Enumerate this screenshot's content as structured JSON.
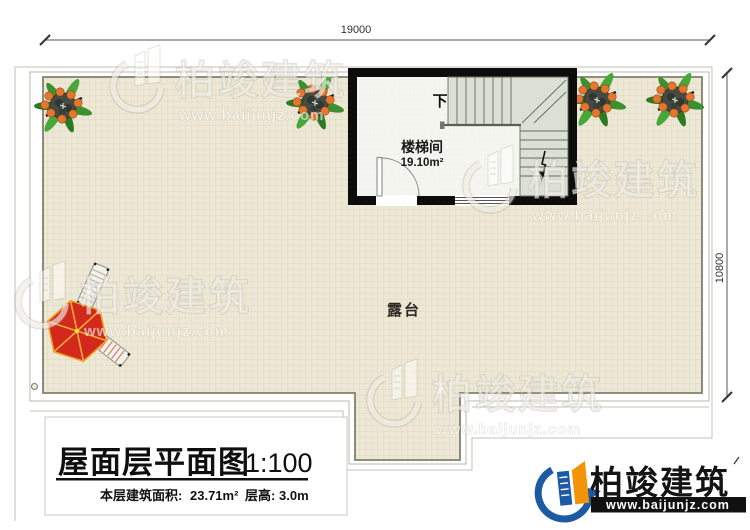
{
  "dimensions": {
    "top": "19000",
    "right": "10800"
  },
  "stairwell": {
    "name": "楼梯间",
    "area": "19.10m²",
    "direction": "下"
  },
  "terrace": {
    "label": "露台"
  },
  "title_block": {
    "title": "屋面层平面图",
    "scale": "1:100",
    "area_label": "本层建筑面积:",
    "area_value": "23.71m²",
    "floor_height_label": "层高:",
    "floor_height_value": "3.0m"
  },
  "logo": {
    "brand": "柏竣建筑",
    "website": "www.baijunjz.com"
  },
  "watermark": {
    "brand": "柏竣建筑",
    "website": "www.baijunjz.com"
  },
  "colors": {
    "terrace_fill": "#ede8d5",
    "terrace_grid": "#d8d0b4",
    "wall_black": "#0d0d0d",
    "stair_shade": "#dbe0d5",
    "umbrella_red": "#d2291c",
    "umbrella_rib": "#f2a93b",
    "plant_leaf": "#3b9130",
    "plant_fruit": "#e4762e",
    "logo_blue": "#1d5aa4",
    "logo_orange": "#f39307"
  }
}
